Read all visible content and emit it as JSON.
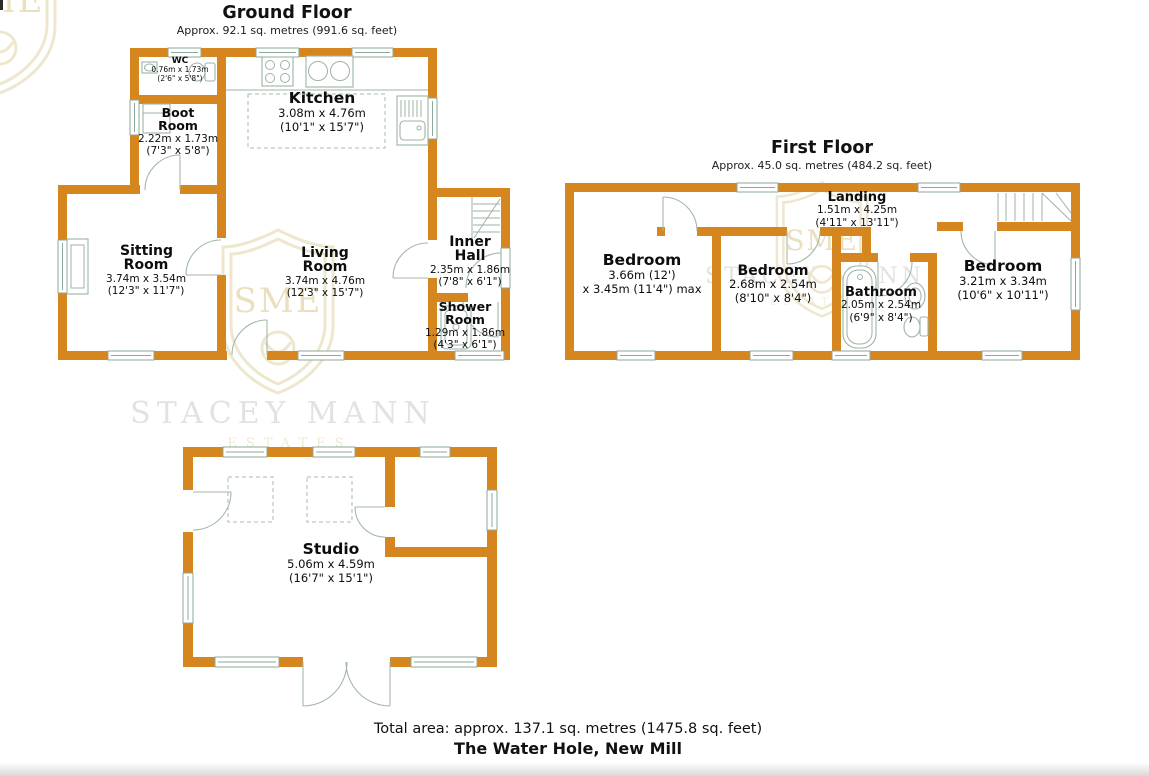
{
  "page": {
    "footer_total": "Total area: approx. 137.1 sq. metres (1475.8 sq. feet)",
    "footer_address": "The Water Hole, New Mill",
    "watermark": {
      "name": "STACEY MANN",
      "sub": "ESTATES",
      "monogram": "SME"
    },
    "colors": {
      "wall": "#D6861E",
      "window_frame": "#8CA89A",
      "text": "#111111",
      "watermark_gray": "#E2E2E2",
      "crest_gold": "#EDE4C8"
    }
  },
  "floors": [
    {
      "id": "ground",
      "title": "Ground Floor",
      "subtitle": "Approx. 92.1 sq. metres (991.6 sq. feet)",
      "rooms": [
        {
          "name": "WC",
          "metric": "0.76m x 1.73m",
          "imperial": "(2'6\" x 5'8\")"
        },
        {
          "name": "Boot Room",
          "metric": "2.22m x 1.73m",
          "imperial": "(7'3\" x 5'8\")"
        },
        {
          "name": "Kitchen",
          "metric": "3.08m x 4.76m",
          "imperial": "(10'1\" x 15'7\")"
        },
        {
          "name": "Sitting Room",
          "metric": "3.74m x 3.54m",
          "imperial": "(12'3\" x 11'7\")"
        },
        {
          "name": "Living Room",
          "metric": "3.74m x 4.76m",
          "imperial": "(12'3\" x 15'7\")"
        },
        {
          "name": "Inner Hall",
          "metric": "2.35m x 1.86m",
          "imperial": "(7'8\" x 6'1\")"
        },
        {
          "name": "Shower Room",
          "metric": "1.29m x 1.86m",
          "imperial": "(4'3\" x 6'1\")"
        }
      ]
    },
    {
      "id": "first",
      "title": "First Floor",
      "subtitle": "Approx. 45.0 sq. metres (484.2 sq. feet)",
      "rooms": [
        {
          "name": "Landing",
          "metric": "1.51m x 4.25m",
          "imperial": "(4'11\" x 13'11\")"
        },
        {
          "name": "Bedroom",
          "metric": "3.66m (12')",
          "imperial": "x 3.45m (11'4\") max"
        },
        {
          "name": "Bedroom",
          "metric": "2.68m x 2.54m",
          "imperial": "(8'10\" x 8'4\")"
        },
        {
          "name": "Bathroom",
          "metric": "2.05m x 2.54m",
          "imperial": "(6'9\" x 8'4\")"
        },
        {
          "name": "Bedroom",
          "metric": "3.21m x 3.34m",
          "imperial": "(10'6\" x 10'11\")"
        }
      ]
    },
    {
      "id": "studio",
      "rooms": [
        {
          "name": "Studio",
          "metric": "5.06m x 4.59m",
          "imperial": "(16'7\" x 15'1\")"
        }
      ]
    }
  ]
}
